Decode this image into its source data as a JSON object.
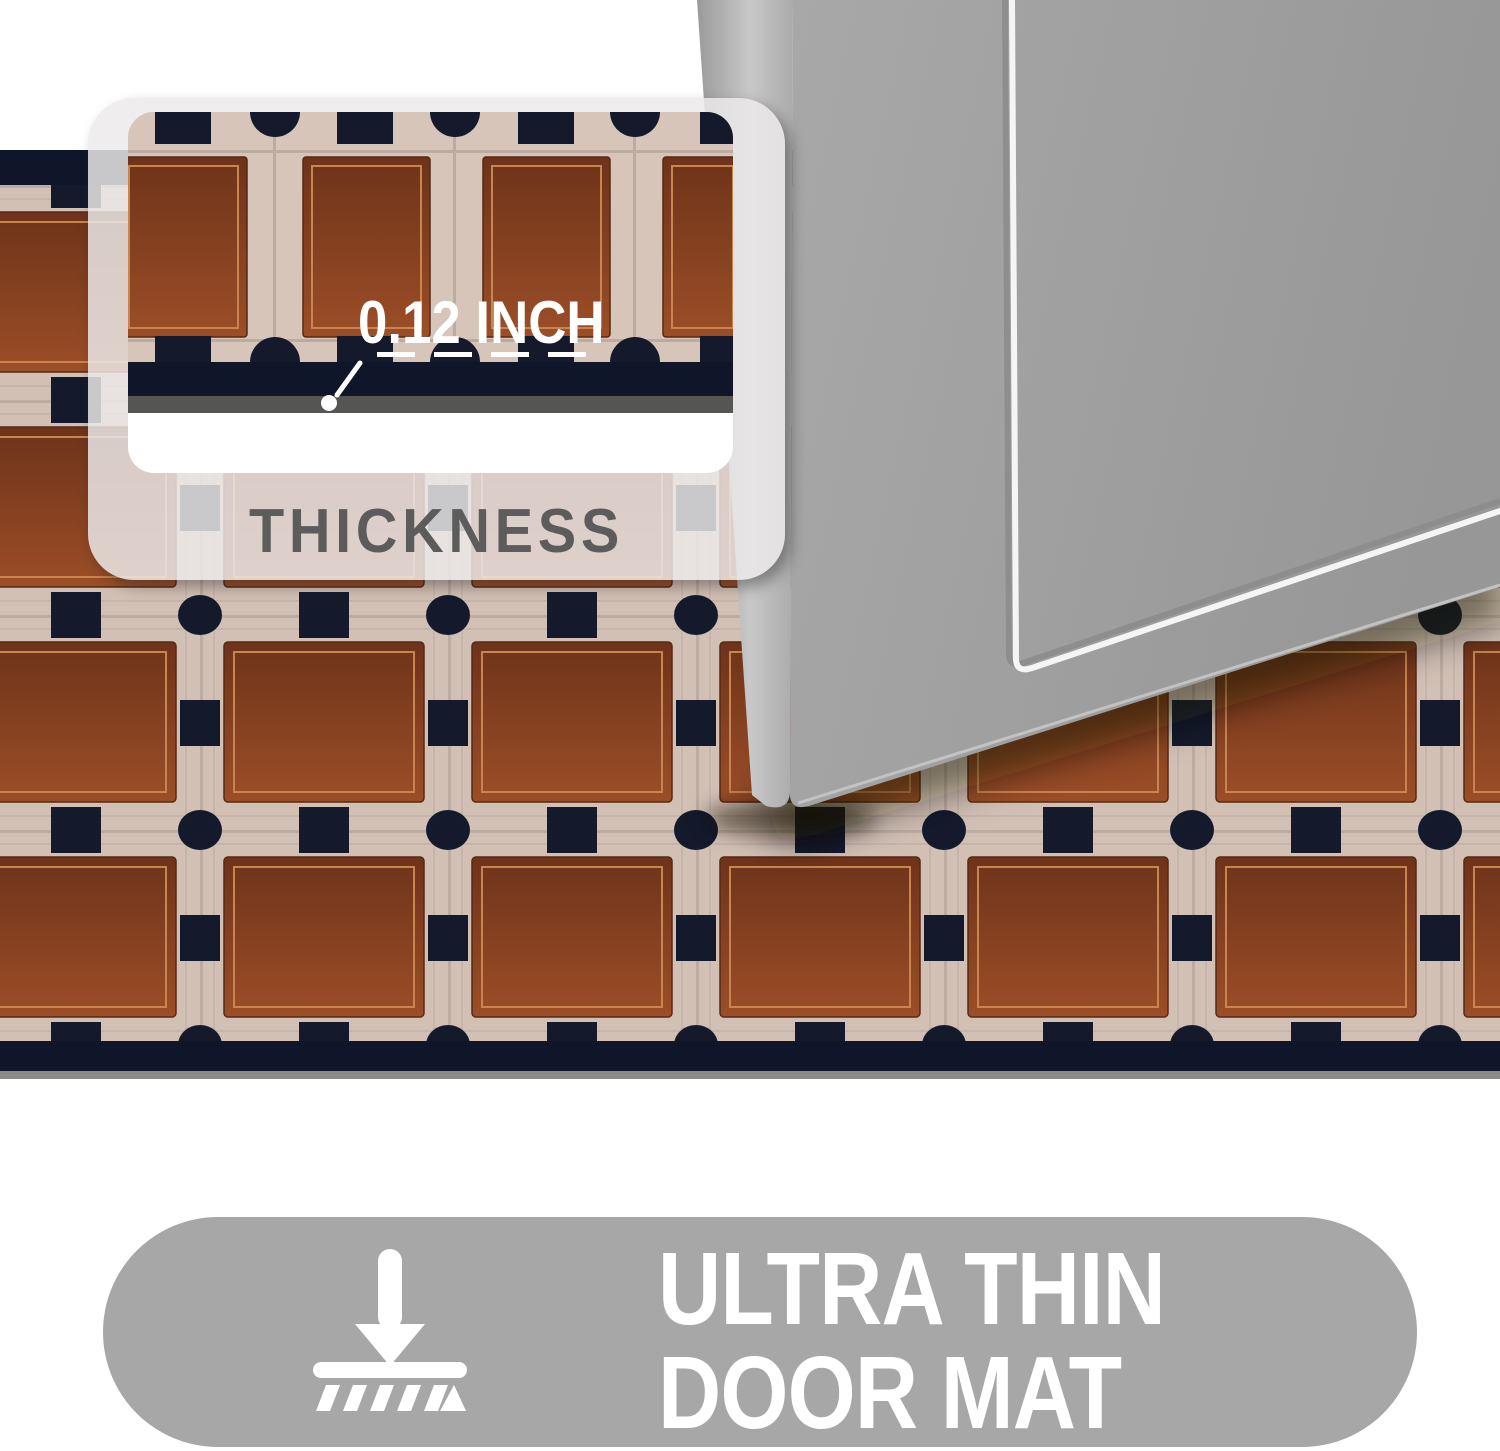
{
  "callout": {
    "value": "0.12 INCH",
    "label": "THICKNESS"
  },
  "banner": {
    "line1": "ULTRA THIN",
    "line2": "DOOR MAT"
  },
  "icons": {
    "banner_icon": "press-flat-broom-icon",
    "pointer_icon": "measure-pointer-icon"
  },
  "colors": {
    "mat-navy": "#10162a",
    "mat-cream": "#d2c0b5",
    "mat-brown-dark": "#6e331a",
    "mat-brown-light": "#9c4e27",
    "square-border": "#c9854e",
    "door-gray": "#9d9d9d",
    "door-edge-gray": "#c2c2c2",
    "panel-bg": "#eceae9",
    "pill-gray": "#a7a7a7",
    "label-gray": "#5c5c5c",
    "floor-shadow": "#8b8b89"
  }
}
